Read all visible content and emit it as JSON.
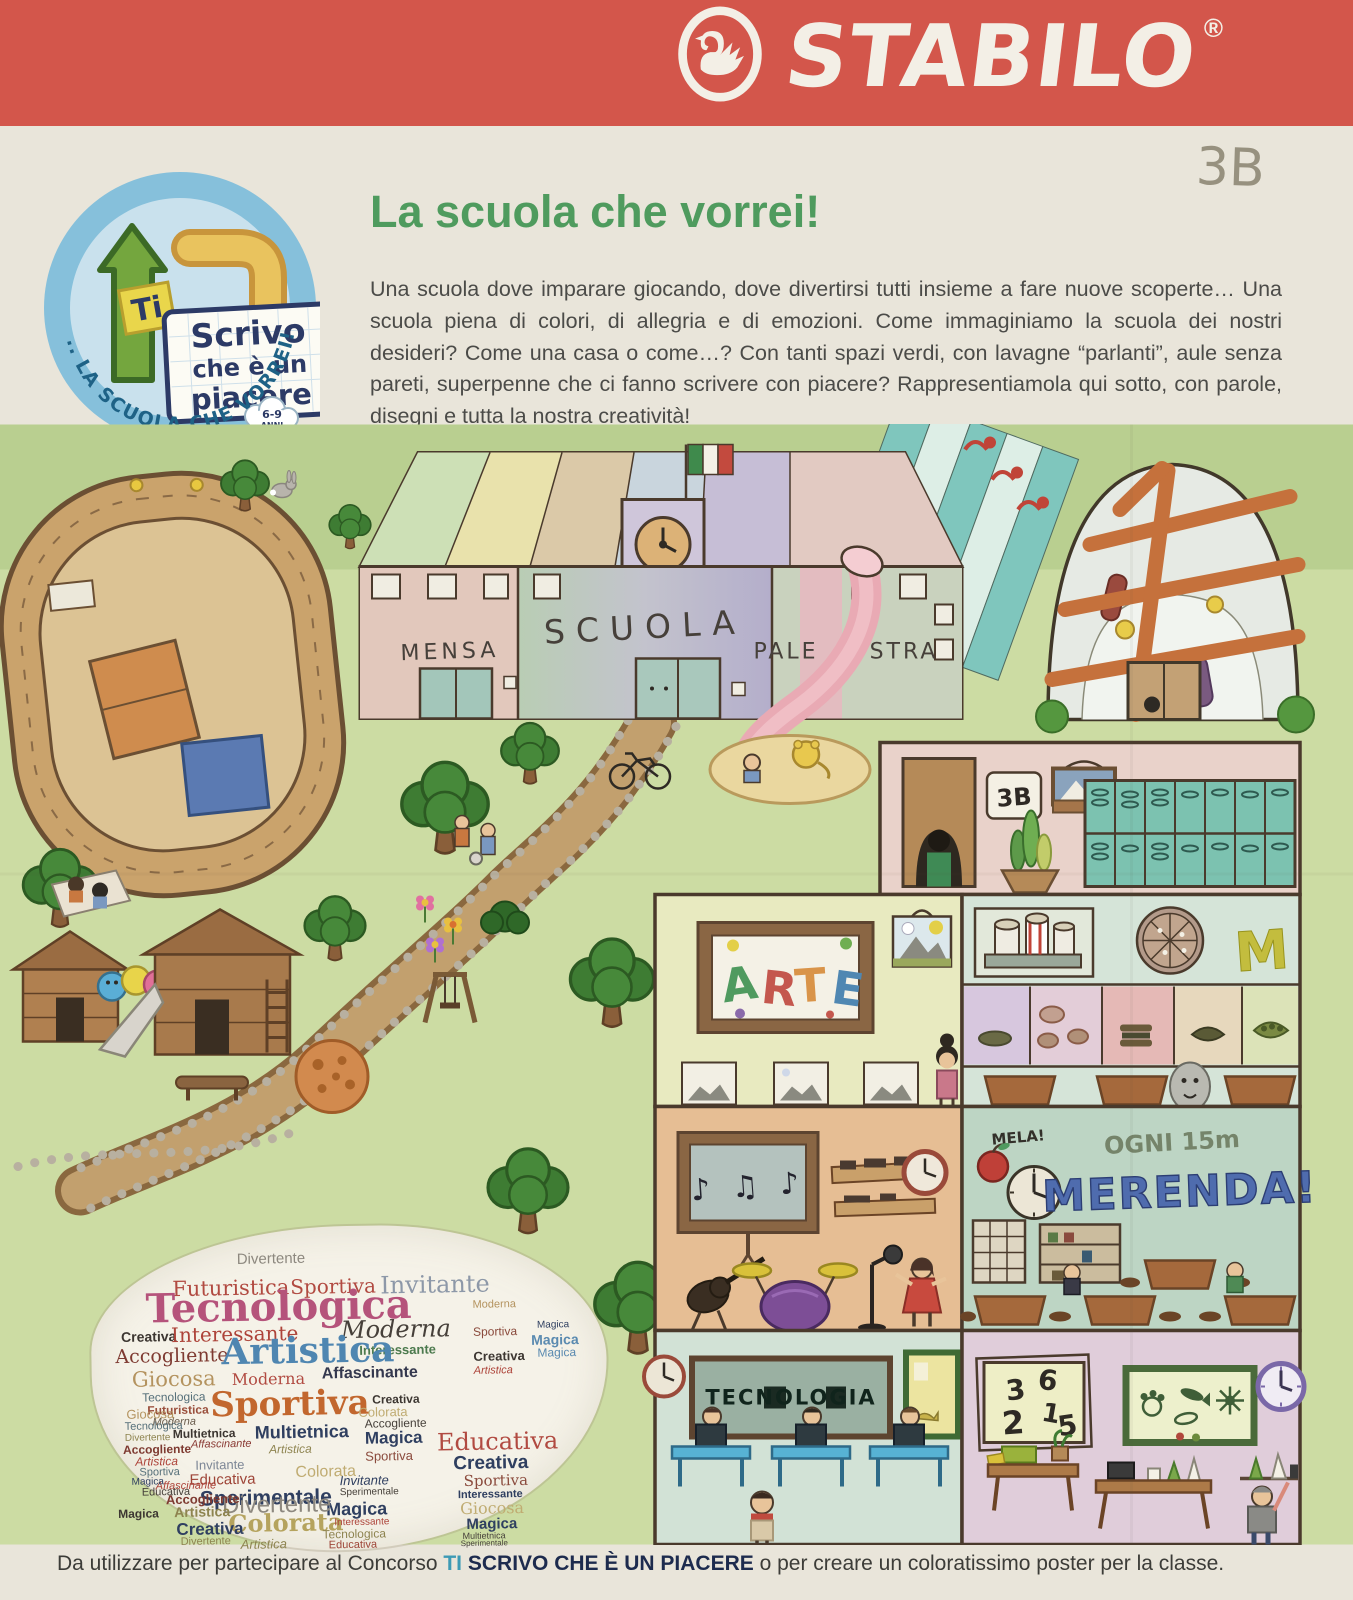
{
  "banner": {
    "brand": "STABILO",
    "registered": "®"
  },
  "class_label": "3B",
  "logo": {
    "ti": "Ti",
    "line1": "Scrivo",
    "line2": "che è un",
    "line3": "piacere",
    "age_line1": "6-9",
    "age_line2": "ANNI",
    "arc_text": "... LA SCUOLA CHE VORREI!"
  },
  "header": {
    "title": "La scuola che vorrei!",
    "paragraph": "Una scuola dove imparare giocando, dove divertirsi tutti insieme a fare nuove scoperte… Una scuola piena di colori, di allegria e di emozioni. Come immaginiamo la scuola dei nostri desideri? Come una casa o come…? Con tanti spazi verdi, con lavagne “parlanti”, aule senza pareti, superpenne che ci fanno scrivere con piacere? Rappresentiamola qui sotto, con parole, disegni e tutta la nostra creatività!"
  },
  "drawing": {
    "labels": {
      "mensa": "MENSA",
      "scuola": "SCUOLA",
      "pale": "PALE",
      "stra": "STRA",
      "arte": [
        "A",
        "R",
        "T",
        "E"
      ],
      "locker_sign": "3B",
      "mela": "MELA!",
      "ogni": "OGNI 15m",
      "merenda": "MERENDA!",
      "tecnologia": "TECNOLOGIA",
      "m_logo": "M",
      "numbers": [
        "3",
        "6",
        "2",
        "1",
        "5"
      ],
      "music_notes": "♪ ♫ ♪"
    }
  },
  "wordcloud": {
    "words": [
      {
        "t": "Divertente",
        "x": 147,
        "y": 24,
        "s": 15,
        "c": "#8d887f"
      },
      {
        "t": "Futuristica",
        "x": 82,
        "y": 50,
        "s": 21,
        "c": "#b14a41",
        "f": 1
      },
      {
        "t": "Sportiva",
        "x": 200,
        "y": 50,
        "s": 20,
        "c": "#b14a41",
        "f": 1
      },
      {
        "t": "Invitante",
        "x": 290,
        "y": 48,
        "s": 24,
        "c": "#8d98a8",
        "f": 1
      },
      {
        "t": "Tecnologica",
        "x": 55,
        "y": 60,
        "s": 40,
        "c": "#b5537b",
        "b": 1,
        "f": 1
      },
      {
        "t": "Creativa",
        "x": 30,
        "y": 100,
        "s": 14,
        "c": "#3c3631",
        "b": 1
      },
      {
        "t": "Interessante",
        "x": 80,
        "y": 96,
        "s": 20,
        "c": "#ad4339",
        "f": 1
      },
      {
        "t": "Moderna",
        "x": 250,
        "y": 92,
        "s": 24,
        "c": "#46403a",
        "f": 1,
        "i": 1
      },
      {
        "t": "Interessante",
        "x": 268,
        "y": 118,
        "s": 13,
        "c": "#4c7a4e",
        "b": 1
      },
      {
        "t": "Accogliente",
        "x": 24,
        "y": 118,
        "s": 19,
        "c": "#7e3a31",
        "f": 1
      },
      {
        "t": "Artistica",
        "x": 130,
        "y": 106,
        "s": 36,
        "c": "#4f86b1",
        "b": 1,
        "f": 1
      },
      {
        "t": "Giocosa",
        "x": 40,
        "y": 140,
        "s": 21,
        "c": "#b4935f",
        "f": 1
      },
      {
        "t": "Moderna",
        "x": 140,
        "y": 144,
        "s": 16,
        "c": "#b14a41",
        "f": 1
      },
      {
        "t": "Affascinante",
        "x": 230,
        "y": 140,
        "s": 16,
        "c": "#34384e",
        "b": 1
      },
      {
        "t": "Sportiva",
        "x": 118,
        "y": 160,
        "s": 34,
        "c": "#c2672e",
        "b": 1,
        "f": 1
      },
      {
        "t": "Tecnologica",
        "x": 50,
        "y": 162,
        "s": 12,
        "c": "#56707a"
      },
      {
        "t": "Futuristica",
        "x": 55,
        "y": 175,
        "s": 12,
        "c": "#9a4f3c",
        "b": 1
      },
      {
        "t": "Moderna",
        "x": 60,
        "y": 188,
        "s": 11,
        "c": "#6a5d4d",
        "i": 1
      },
      {
        "t": "Multietnica",
        "x": 80,
        "y": 199,
        "s": 12,
        "c": "#3c3631",
        "b": 1
      },
      {
        "t": "Affascinante",
        "x": 98,
        "y": 211,
        "s": 11,
        "c": "#8a3a34",
        "i": 1
      },
      {
        "t": "Multietnica",
        "x": 162,
        "y": 196,
        "s": 18,
        "c": "#2f3f60",
        "b": 1
      },
      {
        "t": "Artistica",
        "x": 176,
        "y": 216,
        "s": 12,
        "c": "#8e8450",
        "i": 1
      },
      {
        "t": "Invitante",
        "x": 102,
        "y": 230,
        "s": 13,
        "c": "#7d8796"
      },
      {
        "t": "Educativa",
        "x": 96,
        "y": 244,
        "s": 15,
        "c": "#9e4538"
      },
      {
        "t": "Sperimentale",
        "x": 106,
        "y": 260,
        "s": 21,
        "c": "#2f3f60",
        "b": 1
      },
      {
        "t": "Colorata",
        "x": 202,
        "y": 238,
        "s": 16,
        "c": "#c0ac72"
      },
      {
        "t": "Colorata",
        "x": 134,
        "y": 284,
        "s": 24,
        "c": "#b5a35e",
        "b": 1,
        "f": 1
      },
      {
        "t": "Artistica",
        "x": 146,
        "y": 310,
        "s": 13,
        "c": "#8e8450",
        "i": 1
      },
      {
        "t": "Magica",
        "x": 272,
        "y": 204,
        "s": 17,
        "c": "#2f3f60",
        "b": 1
      },
      {
        "t": "Accogliente",
        "x": 272,
        "y": 192,
        "s": 12,
        "c": "#46403a"
      },
      {
        "t": "Colorata",
        "x": 266,
        "y": 180,
        "s": 13,
        "c": "#c0ac72"
      },
      {
        "t": "Creativa",
        "x": 280,
        "y": 168,
        "s": 12,
        "c": "#3c3631",
        "b": 1
      },
      {
        "t": "Sportiva",
        "x": 272,
        "y": 224,
        "s": 13,
        "c": "#8a4a3c"
      },
      {
        "t": "Invitante",
        "x": 246,
        "y": 248,
        "s": 13,
        "c": "#2f3f60",
        "i": 1
      },
      {
        "t": "Sperimentale",
        "x": 246,
        "y": 262,
        "s": 10,
        "c": "#46403a"
      },
      {
        "t": "Magica",
        "x": 232,
        "y": 274,
        "s": 18,
        "c": "#2f3f60",
        "b": 1
      },
      {
        "t": "Interessante",
        "x": 240,
        "y": 292,
        "s": 10,
        "c": "#ad4339"
      },
      {
        "t": "Tecnologica",
        "x": 228,
        "y": 302,
        "s": 12,
        "c": "#8e8450"
      },
      {
        "t": "Educativa",
        "x": 234,
        "y": 314,
        "s": 11,
        "c": "#9e4538"
      },
      {
        "t": "Divertente",
        "x": 128,
        "y": 266,
        "s": 24,
        "c": "#8d887f"
      },
      {
        "t": "Artistica",
        "x": 80,
        "y": 276,
        "s": 14,
        "c": "#8e8450",
        "b": 1
      },
      {
        "t": "Accogliente",
        "x": 72,
        "y": 264,
        "s": 13,
        "c": "#7e3a31",
        "b": 1
      },
      {
        "t": "Affascinante",
        "x": 62,
        "y": 252,
        "s": 11,
        "c": "#ad4339",
        "i": 1
      },
      {
        "t": "Creativa",
        "x": 82,
        "y": 292,
        "s": 17,
        "c": "#2f3f60",
        "b": 1
      },
      {
        "t": "Divertente",
        "x": 86,
        "y": 308,
        "s": 11,
        "c": "#8e8450"
      },
      {
        "t": "Magica",
        "x": 24,
        "y": 278,
        "s": 12,
        "c": "#3c3631",
        "b": 1
      },
      {
        "t": "Giocosa",
        "x": 34,
        "y": 178,
        "s": 13,
        "c": "#b4935f"
      },
      {
        "t": "Tecnologica",
        "x": 32,
        "y": 192,
        "s": 11,
        "c": "#56707a"
      },
      {
        "t": "Divertente",
        "x": 32,
        "y": 204,
        "s": 10,
        "c": "#8e8450"
      },
      {
        "t": "Accogliente",
        "x": 30,
        "y": 214,
        "s": 12,
        "c": "#7e3a31",
        "b": 1
      },
      {
        "t": "Artistica",
        "x": 42,
        "y": 226,
        "s": 12,
        "c": "#ad4339",
        "i": 1
      },
      {
        "t": "Sportiva",
        "x": 46,
        "y": 238,
        "s": 11,
        "c": "#56707a"
      },
      {
        "t": "Magica",
        "x": 38,
        "y": 248,
        "s": 10,
        "c": "#2f3f60"
      },
      {
        "t": "Educativa",
        "x": 48,
        "y": 258,
        "s": 11,
        "c": "#46403a"
      },
      {
        "t": "Moderna",
        "x": 382,
        "y": 76,
        "s": 11,
        "c": "#b4935f"
      },
      {
        "t": "Sportiva",
        "x": 382,
        "y": 102,
        "s": 12,
        "c": "#8a4a3c"
      },
      {
        "t": "Creativa",
        "x": 382,
        "y": 126,
        "s": 13,
        "c": "#3c3631",
        "b": 1
      },
      {
        "t": "Artistica",
        "x": 382,
        "y": 142,
        "s": 11,
        "c": "#ad4339",
        "i": 1
      },
      {
        "t": "Magica",
        "x": 446,
        "y": 98,
        "s": 10,
        "c": "#2f3f60"
      },
      {
        "t": "Magica",
        "x": 440,
        "y": 110,
        "s": 14,
        "c": "#5a8ab0",
        "b": 1
      },
      {
        "t": "Magica",
        "x": 446,
        "y": 124,
        "s": 12,
        "c": "#5a8ab0"
      },
      {
        "t": "Educativa",
        "x": 344,
        "y": 206,
        "s": 24,
        "c": "#b14a41",
        "f": 1
      },
      {
        "t": "Creativa",
        "x": 360,
        "y": 230,
        "s": 19,
        "c": "#2f3f60",
        "b": 1
      },
      {
        "t": "Sportiva",
        "x": 370,
        "y": 250,
        "s": 15,
        "c": "#8a4a3c",
        "f": 1
      },
      {
        "t": "Interessante",
        "x": 364,
        "y": 266,
        "s": 11,
        "c": "#2f3f60",
        "b": 1
      },
      {
        "t": "Giocosa",
        "x": 366,
        "y": 277,
        "s": 16,
        "c": "#c0ac72",
        "f": 1
      },
      {
        "t": "Magica",
        "x": 372,
        "y": 293,
        "s": 15,
        "c": "#2f3f60",
        "b": 1
      },
      {
        "t": "Multietnica",
        "x": 368,
        "y": 308,
        "s": 9,
        "c": "#46403a"
      },
      {
        "t": "Sperimentale",
        "x": 366,
        "y": 316,
        "s": 8,
        "c": "#46403a"
      }
    ]
  },
  "footer": {
    "prefix": "Da utilizzare per partecipare al Concorso ",
    "highlight": "TI",
    "highlight_bold": " SCRIVO CHE È UN PIACERE",
    "suffix": " o per creare un coloratissimo poster per la classe."
  }
}
